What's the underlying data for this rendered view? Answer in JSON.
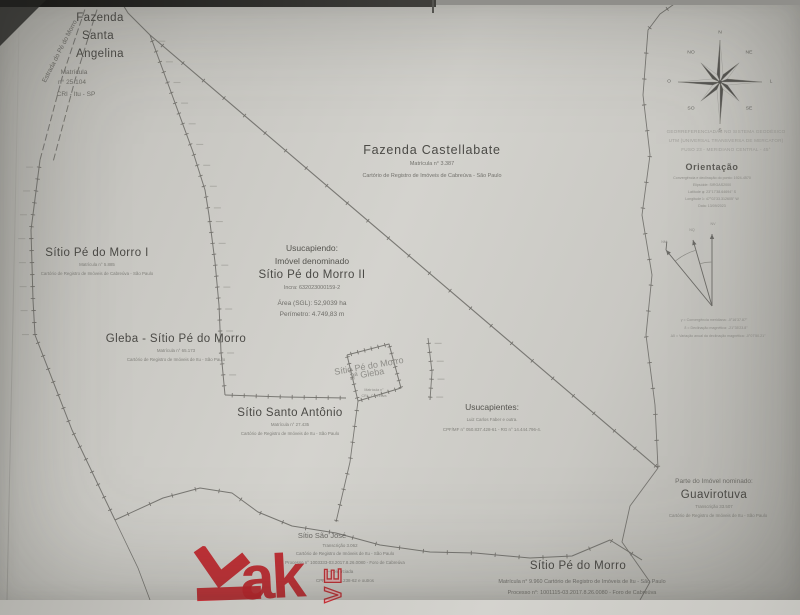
{
  "colors": {
    "ink": "#4b4a46",
    "ink_light": "#8e8d88",
    "red": "#c3232a",
    "paper": "#cdccc7"
  },
  "road": {
    "label": "Estrada do Pé do Morro"
  },
  "parcels": {
    "santa_angelina": {
      "line1": "Fazenda",
      "line2": "Santa",
      "line3": "Angelina",
      "m1": "Matrícula",
      "m2": "n° 25.104",
      "m3": "CRI - Itu - SP"
    },
    "castellabate": {
      "name": "Fazenda Castellabate",
      "matricula": "Matrícula n° 3.387",
      "cartorio": "Cartório de Registro de Imóveis de Cabreúva - São Paulo"
    },
    "pe_do_morro_i": {
      "name": "Sítio Pé do Morro I",
      "matricula": "Matrícula n° 5.885",
      "cartorio": "Cartório de Registro de Imóveis de Cabreúva - São Paulo"
    },
    "usucapiendo": {
      "header": "Usucapiendo:",
      "sub": "Imóvel denominado",
      "name": "Sítio Pé do Morro II",
      "incra": "Incra: 632023000159-2",
      "area": "Área (SGL): 52,9039 ha",
      "perimetro": "Perímetro: 4.749,83 m"
    },
    "gleba": {
      "name": "Gleba - Sítio Pé do Morro",
      "matricula": "Matrícula n° 65.173",
      "cartorio": "Cartório de Registro de Imóveis de Itu - São Paulo"
    },
    "santo_antonio": {
      "name": "Sítio Santo Antônio",
      "matricula": "Matrícula n° 27.435",
      "cartorio": "Cartório de Registro de Imóveis de Itu - São Paulo"
    },
    "usucapientes": {
      "title": "Usucapientes:",
      "names": "Luiz Carlos Faber e outra.",
      "documents": "CPF/MF n° 050.837.428-61 - RG n° 14.444.796-4."
    },
    "segunda_gleba": {
      "line1": "Sítio Pé do Morro",
      "line2": "2ª Gleba",
      "d1": "Matrícula n°",
      "d2": "CRI - Cabreúva"
    },
    "guavirotuva": {
      "pre": "Parte do Imóvel nominado:",
      "name": "Guavirotuva",
      "transcricao": "Transcrição 33.507",
      "cartorio": "Cartório de Registro de Imóveis de Itu - São Paulo"
    },
    "sao_jose": {
      "name": "Sítio São José",
      "l1": "Transcrição 3.062",
      "l2": "Cartório de Registro de Imóveis de Itu - São Paulo",
      "l3": "Processo n° 1003333-03.2017.8.26.0080 - Foro de Cabreúva",
      "l4": "— Divorciada",
      "l5": "CPF 080.871.238-62 e outros"
    },
    "pe_do_morro": {
      "name": "Sítio Pé do Morro",
      "l1": "Matrícula n° 9.960 Cartório de Registro de Imóveis de Itu - São Paulo",
      "l2": "Processo n°: 1001115-03.2017.8.26.0080 - Foro de Cabreúva"
    }
  },
  "compass": {
    "points": [
      "N",
      "NE",
      "L",
      "SE",
      "S",
      "SO",
      "O",
      "NO"
    ]
  },
  "coord_note": {
    "l1": "GEORREFERENCIADAS NO SISTEMA GEODÉSICO",
    "l2": "UTM (UNIVERSAL TRANSVERSA DE MERCATOR)",
    "l3": "FUSO 23 - MERIDIANO CENTRAL - 45°"
  },
  "orientacao": {
    "title": "Orientação",
    "l1": "Convergência e declinação do ponto: 1924-4570",
    "l2": "Elipsóide: SIRGAS2000",
    "l3": "Latitude φ: 23°17'38.64694\" S",
    "l4": "Longitude λ: 47°02'33.312605\" W",
    "l5": "Data: 13/09/2023"
  },
  "declination": {
    "n_left": "NM",
    "n_mid": "NQ",
    "n_right": "NV",
    "l1": "γ = Convergência meridiana: -0°16'37.87\"",
    "l2": "δ = Declinação magnética: -21°35'23.8\"",
    "l3": "Δδ = Variação anual da declinação magnética: -0°07'50.21\""
  },
  "watermark": {
    "letters": "ak",
    "vertical": "VE"
  }
}
